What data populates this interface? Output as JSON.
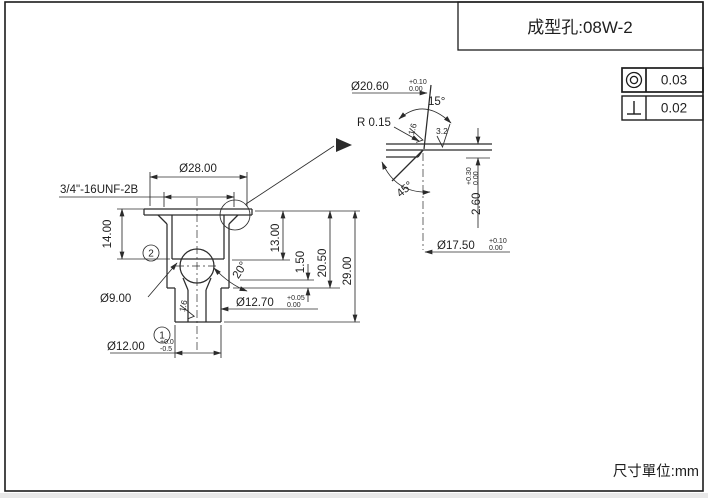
{
  "title_block": {
    "part_label": "成型孔:08W-2"
  },
  "unit_note": "尺寸單位:mm",
  "gdt": [
    {
      "symbol": "concentricity-symbol",
      "value": "0.03"
    },
    {
      "symbol": "perpendicularity-symbol",
      "value": "0.02"
    }
  ],
  "main_view": {
    "balloon_top": "2",
    "balloon_bottom": "1",
    "dims": {
      "flange_dia": "Ø28.00",
      "thread": "3/4\"-16UNF-2B",
      "h14": "14.00",
      "h13": "13.00",
      "h150": "1.50",
      "h2050": "20.50",
      "h2900": "29.00",
      "cone_angle": "20°",
      "d9": "Ø9.00",
      "d1270": {
        "v": "Ø12.70",
        "up": "+0.05",
        "dn": "0.00"
      },
      "d1200": {
        "v": "Ø12.00",
        "up": "+0.0",
        "dn": "-0.5"
      },
      "rough16": "1.6"
    }
  },
  "detail_view": {
    "dims": {
      "d2060": {
        "v": "Ø20.60",
        "up": "+0.10",
        "dn": "0.00"
      },
      "r015": "R 0.15",
      "a15": "15°",
      "a45": "45°",
      "h260": {
        "v": "2.60",
        "up": "+0.30",
        "dn": "0.00"
      },
      "d1750": {
        "v": "Ø17.50",
        "up": "+0.10",
        "dn": "0.00"
      },
      "rough16": "1.6",
      "rough32": "3.2"
    }
  }
}
